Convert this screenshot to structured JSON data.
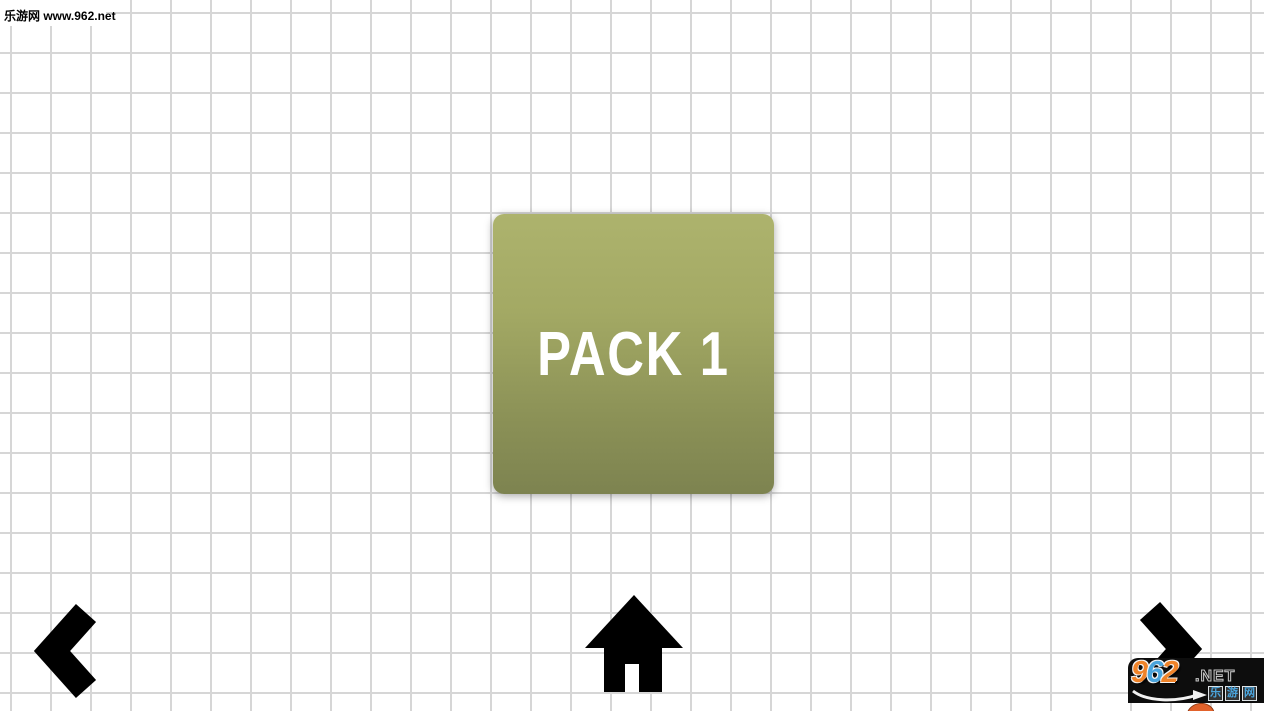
{
  "page": {
    "width": 1264,
    "height": 711,
    "grid": {
      "cell_size_px": 40,
      "line_color": "#d6d6d6",
      "background": "#ffffff"
    }
  },
  "top_watermark": {
    "label": "乐游网 www.962.net"
  },
  "pack_select": {
    "pack_label": "PACK 1",
    "button_colors": {
      "top": "#adb36d",
      "bottom": "#7d8350",
      "text": "#ffffff"
    }
  },
  "nav": {
    "prev_icon": "chevron-left",
    "home_icon": "home",
    "next_icon": "chevron-right",
    "icon_color": "#000000"
  },
  "site_watermark": {
    "digits": [
      {
        "char": "9",
        "color": "#ef8329"
      },
      {
        "char": "6",
        "color": "#4aa4dc"
      },
      {
        "char": "2",
        "color": "#ef8329"
      }
    ],
    "tld": ".NET",
    "site_name_chars": [
      "乐",
      "游",
      "网"
    ],
    "site_name_color": "#4aa4dc",
    "box_background": "#0d0d0d"
  }
}
